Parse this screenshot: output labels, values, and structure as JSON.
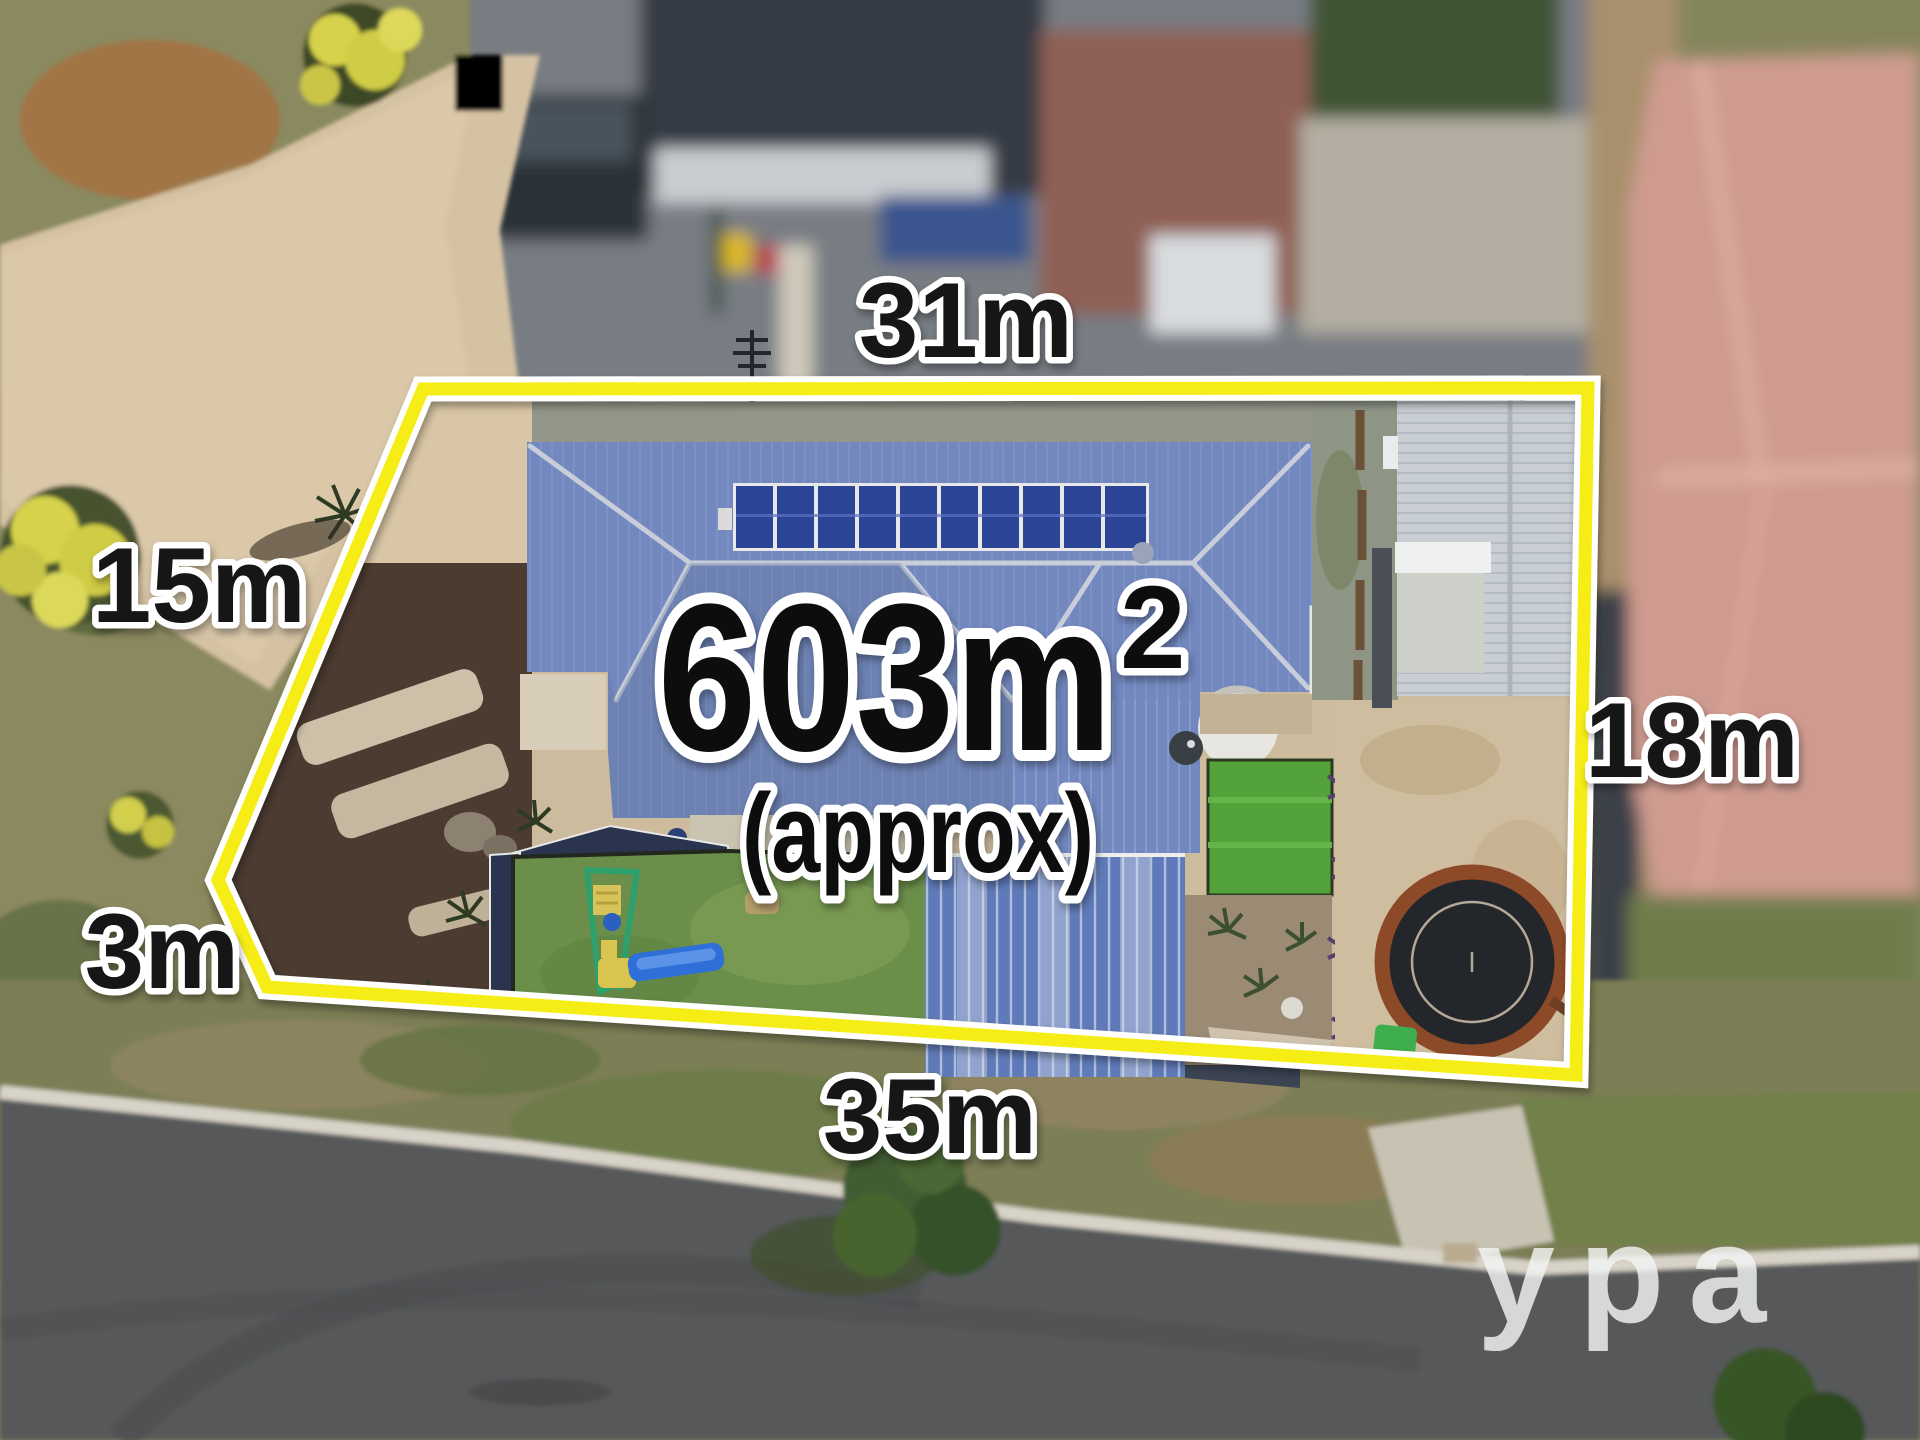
{
  "lot": {
    "area_value": "603m",
    "area_exponent": "2",
    "area_qualifier": "(approx)",
    "dimensions": {
      "top": "31m",
      "left": "15m",
      "bottom_left": "3m",
      "right": "18m",
      "bottom": "35m"
    },
    "boundary_color": "#f6ed15",
    "boundary_casing_color": "#ffffff",
    "label_text_color": "#141414",
    "label_outline_color": "#ffffff"
  },
  "watermark": {
    "text": "ypa",
    "color": "#ffffff"
  },
  "scene_palette": {
    "main_house_roof": "#7288bf",
    "solar_panel": "#2c4495",
    "garage_roof": "#c9ced4",
    "pergola_roof": "#5f7ab8",
    "lawn": "#6b8f4a",
    "artificial_turf": "#53a23a",
    "mulch": "#4b3b31",
    "sand_yard": "#cfbd9f",
    "trampoline_mat": "#23272c",
    "trampoline_ring": "#8d4a28",
    "neighbour_roof_pink": "#cf9b90",
    "neighbour_roof_charcoal": "#343a44",
    "road": "#56585a",
    "concrete": "#d5c2a3",
    "scrub_grass": "#8b895e"
  }
}
